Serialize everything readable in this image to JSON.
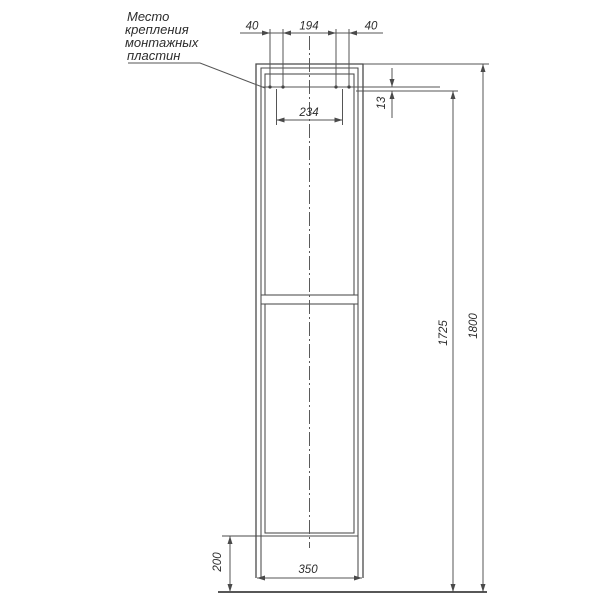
{
  "drawing": {
    "note": {
      "line1": "Место",
      "line2": "крепления",
      "line3": "монтажных",
      "line4": "пластин"
    },
    "dims": {
      "plate_edge_left": "40",
      "plate_gap": "194",
      "plate_edge_right": "40",
      "plate_centers": "234",
      "plate_top_offset": "13",
      "door_height": "1725",
      "total_height": "1800",
      "plinth_height": "200",
      "width": "350"
    },
    "colors": {
      "background": "#ffffff",
      "structure_line": "#4a4a4a",
      "dimension_line": "#555555",
      "text": "#2d2d2d"
    }
  }
}
